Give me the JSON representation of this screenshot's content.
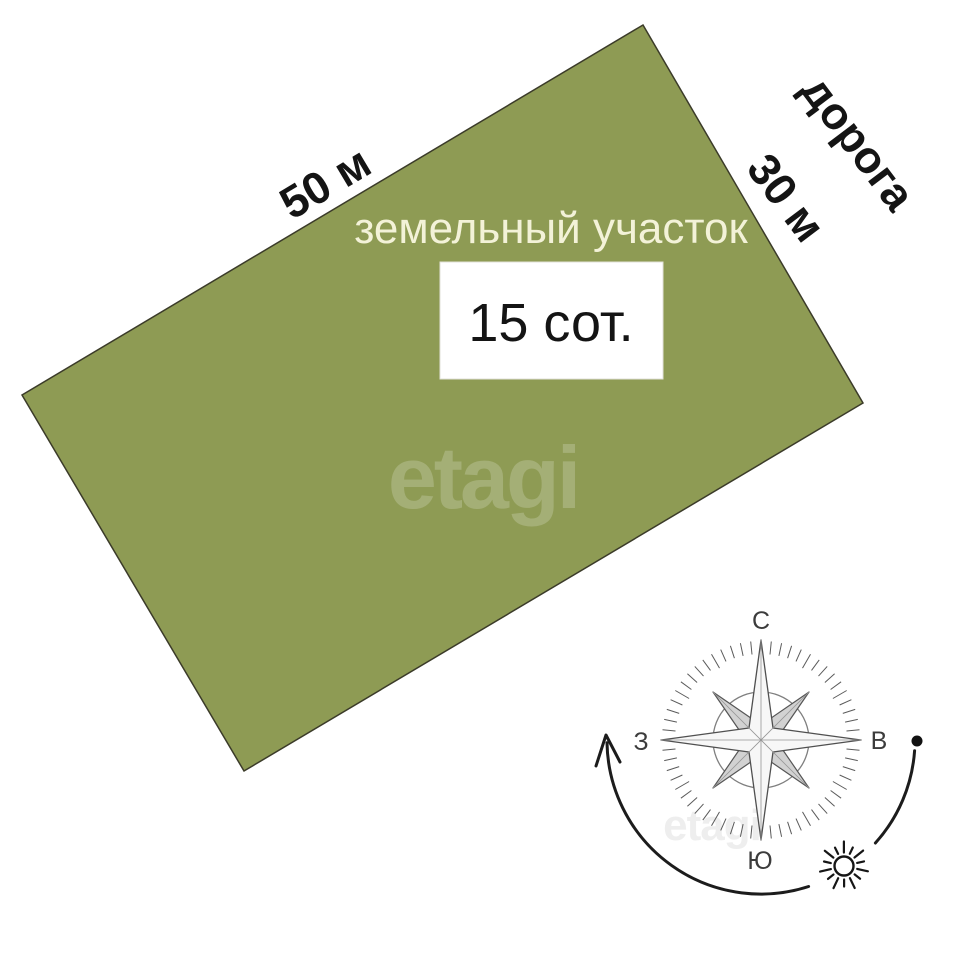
{
  "plot": {
    "label": "земельный участок",
    "area": "15 сот.",
    "frontage": "50 м",
    "depth": "30 м"
  },
  "road": {
    "label": "дорога"
  },
  "compass": {
    "north": "С",
    "east": "В",
    "south": "Ю",
    "west": "З"
  },
  "watermark": {
    "brand": "etagi",
    "brand_faint": "etagi"
  },
  "colors": {
    "plot_fill": "#8e9b54",
    "plot_border": "#3b3b29",
    "plot_label_text": "#f3f2d8",
    "dimension_text": "#141414",
    "compass_text": "#3c3c3c",
    "background": "#ffffff"
  }
}
